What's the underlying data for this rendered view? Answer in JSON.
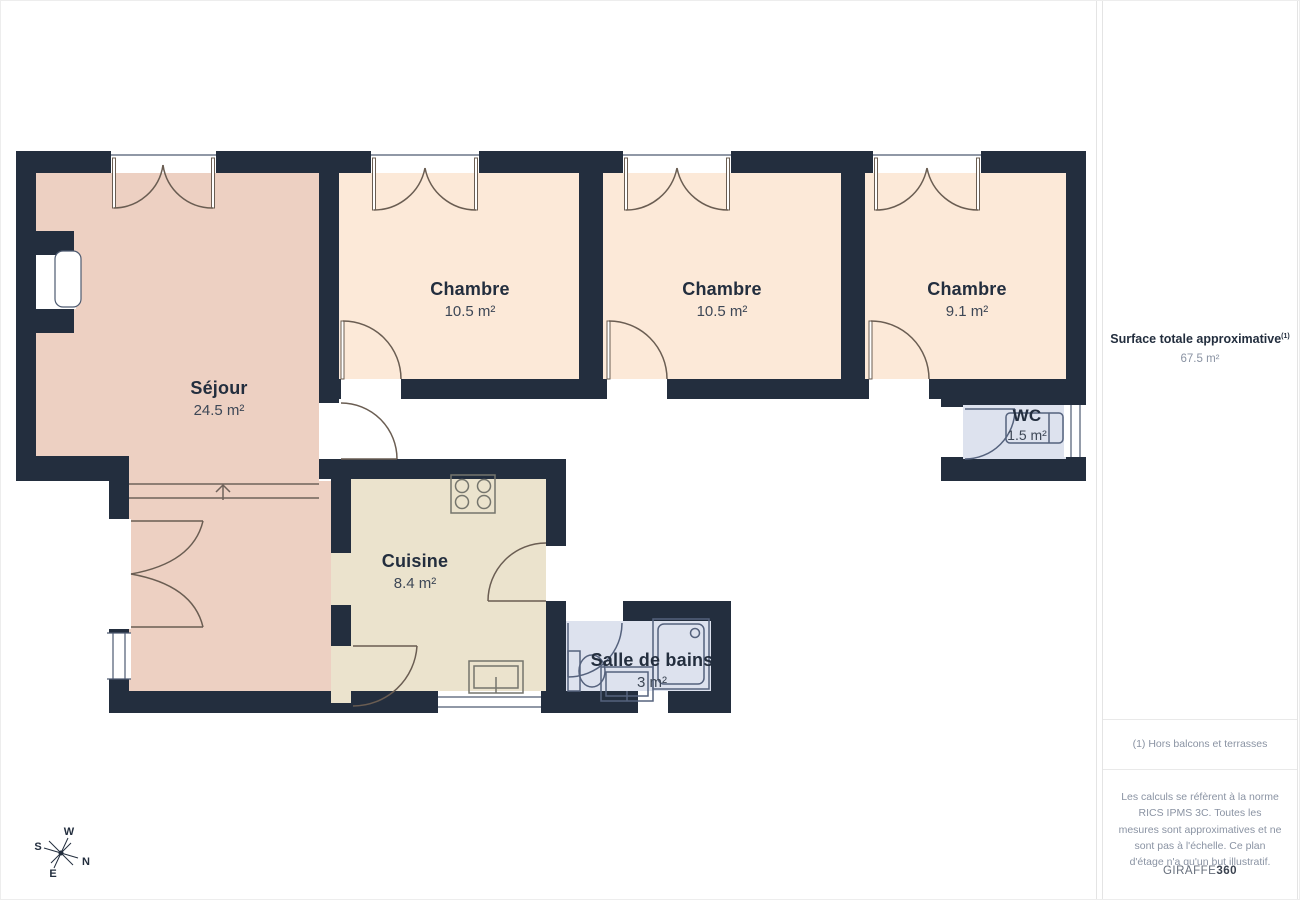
{
  "plan": {
    "rooms": [
      {
        "id": "sejour",
        "name": "Séjour",
        "area": "24.5 m²"
      },
      {
        "id": "chambre1",
        "name": "Chambre",
        "area": "10.5 m²"
      },
      {
        "id": "chambre2",
        "name": "Chambre",
        "area": "10.5 m²"
      },
      {
        "id": "chambre3",
        "name": "Chambre",
        "area": "9.1 m²"
      },
      {
        "id": "wc",
        "name": "WC",
        "area": "1.5 m²"
      },
      {
        "id": "cuisine",
        "name": "Cuisine",
        "area": "8.4 m²"
      },
      {
        "id": "salle_de_bains",
        "name": "Salle de bains",
        "area": "3 m²"
      }
    ],
    "compass": {
      "n": "N",
      "s": "S",
      "e": "E",
      "w": "W"
    },
    "colors": {
      "wall": "#232e3e",
      "sejour": "#edd0c2",
      "chambre": "#fce9d8",
      "cuisine": "#ebe3cd",
      "wet": "#dde2ee"
    }
  },
  "sidebar": {
    "title": "Surface totale approximative",
    "title_sup": "(1)",
    "total_area": "67.5 m²",
    "footnote": "(1) Hors balcons et terrasses",
    "disclaimer": "Les calculs se réfèrent à la norme RICS IPMS 3C. Toutes les mesures sont approximatives et ne sont pas à l'échelle. Ce plan d'étage n'a qu'un but illustratif.",
    "brand": {
      "name": "GIRAFFE",
      "suffix": "360"
    }
  }
}
